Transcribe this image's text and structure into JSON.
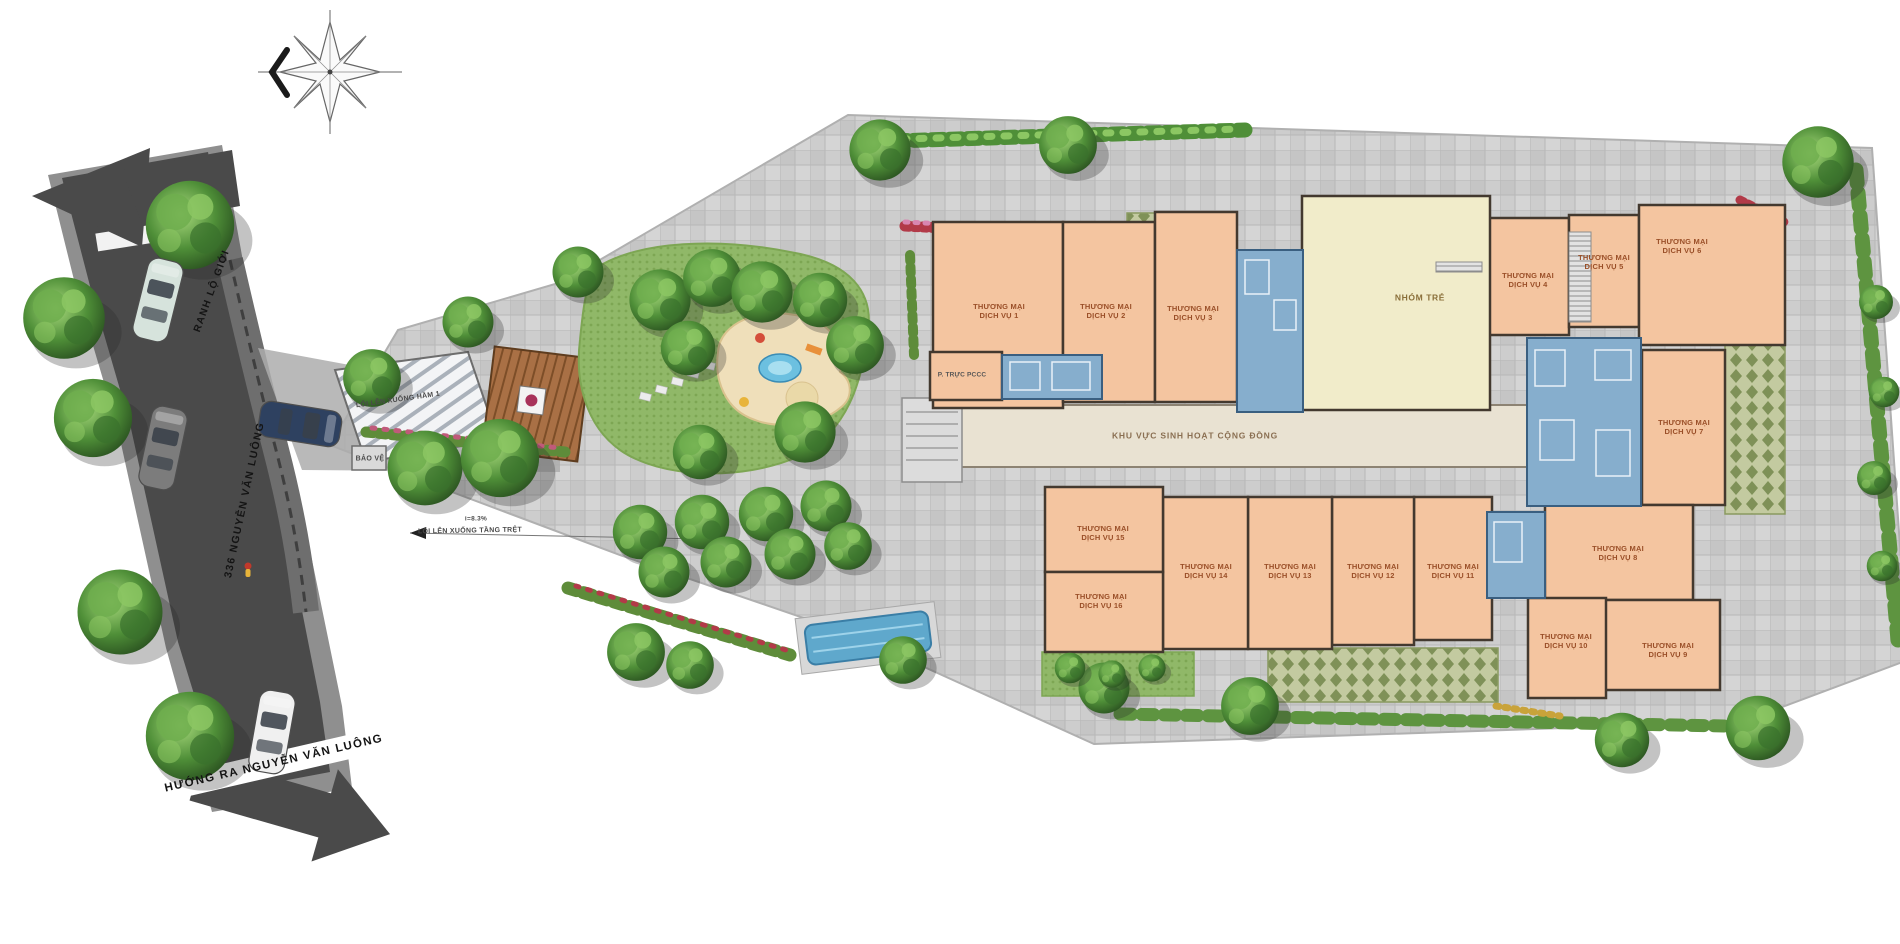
{
  "road": {
    "boundary_label": "RANH LỘ GIỚI",
    "street_label": "336 NGUYỄN VĂN LUÔNG",
    "exit_label": "HƯỚNG RA NGUYỄN VĂN LUÔNG"
  },
  "entries": {
    "basement_ramp_label": "LỐI LÊN XUỐNG HẦM 1",
    "security_label": "BẢO VỆ",
    "ground_ramp_label": "LỐI LÊN XUỐNG TẦNG TRỆT",
    "ground_ramp_slope": "i=8.3%"
  },
  "areas": {
    "community_label": "KHU VỰC SINH HOẠT CỘNG ĐỒNG",
    "kindergarten_label": "NHÓM TRẺ",
    "fire_duty_room_label": "P. TRỰC PCCC"
  },
  "units": [
    {
      "line1": "THƯƠNG MẠI",
      "line2": "DỊCH VỤ 1"
    },
    {
      "line1": "THƯƠNG MẠI",
      "line2": "DỊCH VỤ 2"
    },
    {
      "line1": "THƯƠNG MẠI",
      "line2": "DỊCH VỤ 3"
    },
    {
      "line1": "THƯƠNG MẠI",
      "line2": "DỊCH VỤ 4"
    },
    {
      "line1": "THƯƠNG MẠI",
      "line2": "DỊCH VỤ 5"
    },
    {
      "line1": "THƯƠNG MẠI",
      "line2": "DỊCH VỤ 6"
    },
    {
      "line1": "THƯƠNG MẠI",
      "line2": "DỊCH VỤ 7"
    },
    {
      "line1": "THƯƠNG MẠI",
      "line2": "DỊCH VỤ 8"
    },
    {
      "line1": "THƯƠNG MẠI",
      "line2": "DỊCH VỤ 9"
    },
    {
      "line1": "THƯƠNG MẠI",
      "line2": "DỊCH VỤ 10"
    },
    {
      "line1": "THƯƠNG MẠI",
      "line2": "DỊCH VỤ 11"
    },
    {
      "line1": "THƯƠNG MẠI",
      "line2": "DỊCH VỤ 12"
    },
    {
      "line1": "THƯƠNG MẠI",
      "line2": "DỊCH VỤ 13"
    },
    {
      "line1": "THƯƠNG MẠI",
      "line2": "DỊCH VỤ 14"
    },
    {
      "line1": "THƯƠNG MẠI",
      "line2": "DỊCH VỤ 15"
    },
    {
      "line1": "THƯƠNG MẠI",
      "line2": "DỊCH VỤ 16"
    }
  ],
  "colors": {
    "unit_fill": "#f4c5a0",
    "wall": "#43392f",
    "core_blue": "#86aecd",
    "kindergarten": "#f1ecca",
    "corridor": "#e9e2d2",
    "paving": "#cdcdcd",
    "road": "#4a4a4a",
    "lawn": "#90b868",
    "green_paver": "#8fa065",
    "water": "#5fa8cc"
  }
}
